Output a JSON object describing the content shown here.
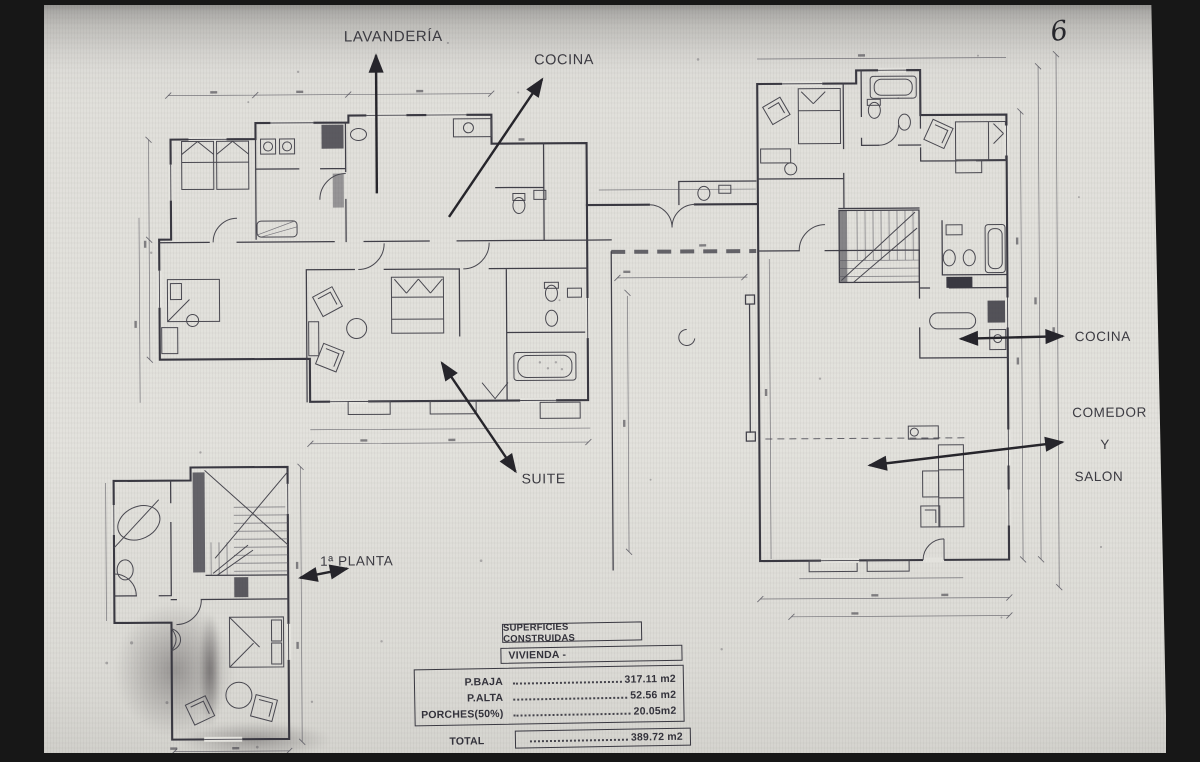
{
  "photo": {
    "page_number": "6"
  },
  "labels": {
    "lavanderia": "LAVANDERÍA",
    "cocina_top": "COCINA",
    "suite": "SUITE",
    "primera_planta": "1ª PLANTA",
    "cocina_right": "COCINA",
    "comedor": "COMEDOR",
    "comedor_y": "Y",
    "comedor_salon": "SALON"
  },
  "areas_table": {
    "title": "SUPERFICIES CONSTRUIDAS",
    "group": "VIVIENDA -",
    "rows": [
      {
        "label": "P.BAJA",
        "value": "317.11 m2"
      },
      {
        "label": "P.ALTA",
        "value": "52.56 m2"
      },
      {
        "label": "PORCHES(50%)",
        "value": "20.05m2"
      }
    ],
    "total": {
      "label": "TOTAL",
      "value": "389.72 m2"
    }
  },
  "colors": {
    "paper": "#e0dfda",
    "ink": "#393841",
    "annotation": "#26252b",
    "frame": "#171717"
  }
}
